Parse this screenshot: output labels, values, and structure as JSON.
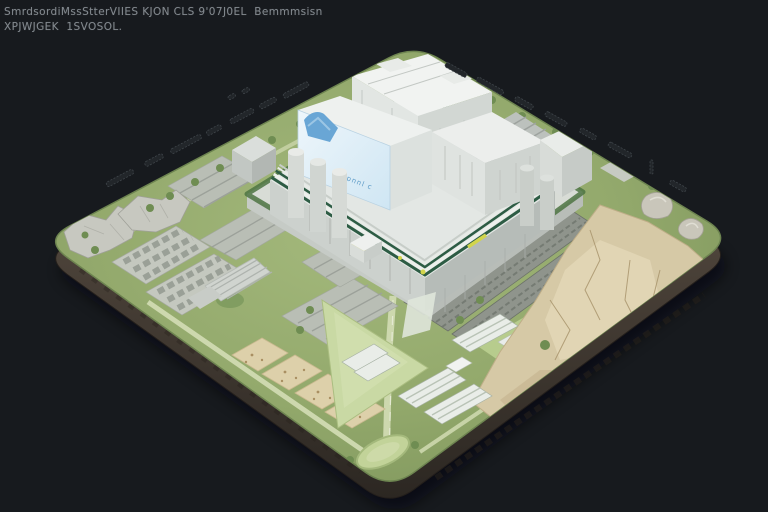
{
  "caption": {
    "line1": "SmrdsordiMssStterVIIES KJON CLS 9'07J0EL  Bemmmsisn",
    "line2": "XPJWJGEK  1SVOSOL."
  },
  "billboard": {
    "sign_text": "pnnl c"
  },
  "colors": {
    "background": "#171a1e",
    "captionText": "#8f969c",
    "grass": "#93a96c",
    "field": "#c9d9a4",
    "road": "#cdd8ae",
    "dirt": "#d6c9a6",
    "dirtLight": "#e2d6b6",
    "padTan": "#ddd0aa",
    "lotGray": "#b9beb5",
    "arrayGray": "#8f948c",
    "rock": "#c7c8c0",
    "buildingTop": "#f1f3f1",
    "podium": "#e3e7e4",
    "billboardBlue": "#dcedf7",
    "logoBlue": "#69a6d5",
    "stripeGreen": "#2d5c44",
    "stripeYellow": "#d2d54c",
    "hedge": "#4d7443",
    "edgeSide": "#4a4138",
    "tick": "#22262a",
    "pond": "#c2d399",
    "greenhouseWhite": "#e9ede8"
  },
  "map": {
    "regions": [
      {
        "name": "central-building-complex"
      },
      {
        "name": "billboard-sign"
      },
      {
        "name": "parking-lots-west"
      },
      {
        "name": "rock-outcrop-west"
      },
      {
        "name": "solar-array-rows-east"
      },
      {
        "name": "dirt-excavation-east"
      },
      {
        "name": "sand-pads-south"
      },
      {
        "name": "greenhouse-rows-south"
      },
      {
        "name": "field-triangle-south"
      },
      {
        "name": "pond-south-corner"
      },
      {
        "name": "edge-tick-labels"
      }
    ]
  }
}
